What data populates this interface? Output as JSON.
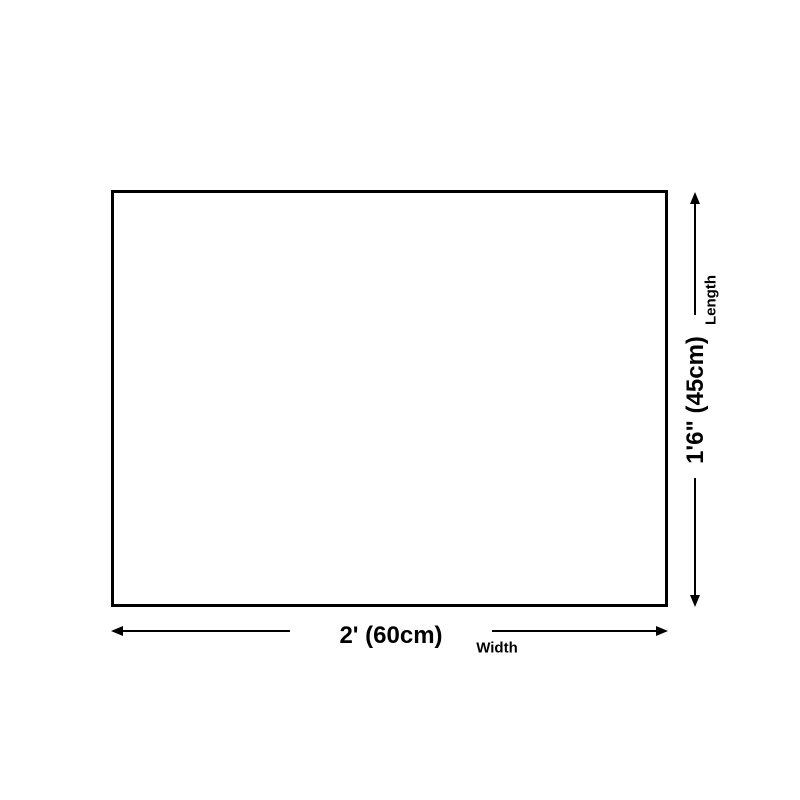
{
  "page": {
    "background_color": "#ffffff",
    "line_color": "#000000"
  },
  "diagram": {
    "type": "product-dimension-diagram",
    "width_dimension": {
      "value": "2' (60cm)",
      "axis_label": "Width"
    },
    "length_dimension": {
      "value": "1'6\" (45cm)",
      "axis_label": "Length"
    }
  }
}
